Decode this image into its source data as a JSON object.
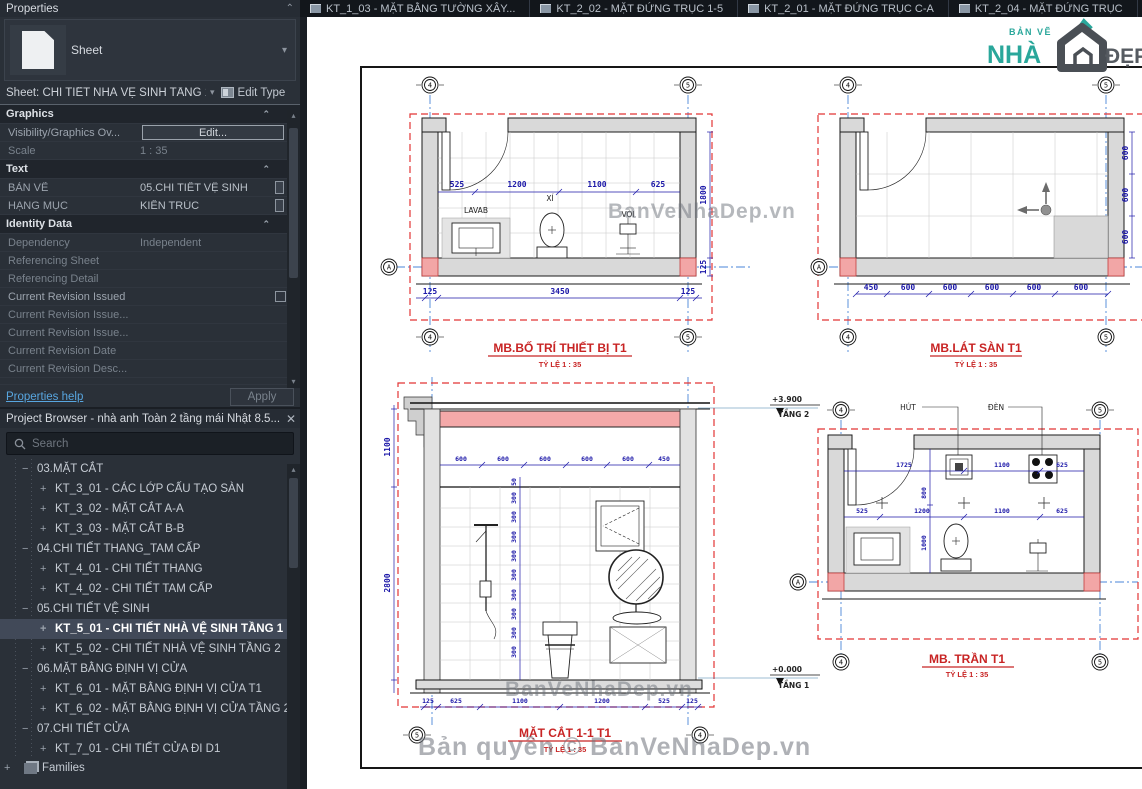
{
  "tabs": [
    {
      "label": "KT_1_03 - MẶT BẰNG TƯỜNG XÂY..."
    },
    {
      "label": "KT_2_02 - MẶT ĐỨNG TRỤC 1-5"
    },
    {
      "label": "KT_2_01 - MẶT ĐỨNG TRỤC C-A"
    },
    {
      "label": "KT_2_04 - MẶT ĐỨNG TRỤC"
    }
  ],
  "properties": {
    "title": "Properties",
    "type_label": "Sheet",
    "selector_label": "Sheet: CHI TIẾT NHÀ VỆ SINH TẦNG 1",
    "edit_type_label": "Edit Type",
    "rows": [
      {
        "kind": "section",
        "label": "Graphics"
      },
      {
        "kind": "row",
        "label": "Visibility/Graphics Ov...",
        "value": "Edit...",
        "control": "button"
      },
      {
        "kind": "row",
        "label": "Scale",
        "value": "1 : 35",
        "dim": "true"
      },
      {
        "kind": "section",
        "label": "Text"
      },
      {
        "kind": "row",
        "label": "BẢN VẼ",
        "value": "05.CHI TIẾT VỆ SINH",
        "tag": "true"
      },
      {
        "kind": "row",
        "label": "HẠNG MỤC",
        "value": "KIẾN TRÚC",
        "tag": "true"
      },
      {
        "kind": "section",
        "label": "Identity Data"
      },
      {
        "kind": "row",
        "label": "Dependency",
        "value": "Independent",
        "dim": "true"
      },
      {
        "kind": "row",
        "label": "Referencing Sheet",
        "value": "",
        "dim": "true"
      },
      {
        "kind": "row",
        "label": "Referencing Detail",
        "value": "",
        "dim": "true"
      },
      {
        "kind": "row",
        "label": "Current Revision Issued",
        "value": "",
        "control": "checkbox"
      },
      {
        "kind": "row",
        "label": "Current Revision Issue...",
        "value": "",
        "dim": "true"
      },
      {
        "kind": "row",
        "label": "Current Revision Issue...",
        "value": "",
        "dim": "true"
      },
      {
        "kind": "row",
        "label": "Current Revision Date",
        "value": "",
        "dim": "true"
      },
      {
        "kind": "row",
        "label": "Current Revision Desc...",
        "value": "",
        "dim": "true"
      }
    ],
    "help_label": "Properties help",
    "apply_label": "Apply"
  },
  "project_browser": {
    "title": "Project Browser - nhà anh Toàn 2 tầng mái Nhật 8.5...",
    "search_placeholder": "Search",
    "tree": [
      {
        "kind": "section",
        "expander": "−",
        "label": "03.MẶT CẮT"
      },
      {
        "kind": "leaf",
        "expander": "+",
        "label": "KT_3_01 - CÁC LỚP CẤU TẠO SÀN"
      },
      {
        "kind": "leaf",
        "expander": "+",
        "label": "KT_3_02 - MẶT CẮT A-A"
      },
      {
        "kind": "leaf",
        "expander": "+",
        "label": "KT_3_03 - MẶT CẮT B-B"
      },
      {
        "kind": "section",
        "expander": "−",
        "label": "04.CHI TIẾT THANG_TAM CẤP"
      },
      {
        "kind": "leaf",
        "expander": "+",
        "label": "KT_4_01 - CHI TIẾT THANG"
      },
      {
        "kind": "leaf",
        "expander": "+",
        "label": "KT_4_02 - CHI TIẾT TAM CẤP"
      },
      {
        "kind": "section",
        "expander": "−",
        "label": "05.CHI TIẾT VỆ SINH"
      },
      {
        "kind": "leaf",
        "expander": "+",
        "label": "KT_5_01 - CHI TIẾT NHÀ VỆ SINH TẦNG 1",
        "selected": "true"
      },
      {
        "kind": "leaf",
        "expander": "+",
        "label": "KT_5_02 - CHI TIẾT NHÀ VỆ SINH TẦNG 2"
      },
      {
        "kind": "section",
        "expander": "−",
        "label": "06.MẶT BẰNG ĐỊNH VỊ CỬA"
      },
      {
        "kind": "leaf",
        "expander": "+",
        "label": "KT_6_01 - MẶT BẰNG ĐỊNH VỊ CỬA T1"
      },
      {
        "kind": "leaf",
        "expander": "+",
        "label": "KT_6_02 - MẶT BẰNG ĐỊNH VỊ CỬA TẦNG 2"
      },
      {
        "kind": "section",
        "expander": "−",
        "label": "07.CHI TIẾT CỬA"
      },
      {
        "kind": "leaf",
        "expander": "+",
        "label": "KT_7_01 - CHI TIẾT CỬA ĐI D1"
      }
    ],
    "families_label": "Families"
  },
  "canvas": {
    "logo": {
      "small": "BẢN VẼ",
      "main": "NHÀ",
      "suffix": "ĐẸP"
    },
    "watermarks": {
      "plan": "BanVeNhaDep.vn",
      "section": "BanVeNhaDep.vn",
      "copyright": "Bản quyền © BanVeNhaDep.vn"
    },
    "drawings": [
      {
        "name": "MB.BỐ TRÍ THIẾT BỊ T1",
        "scale_label": "TỶ LỆ 1 : 35",
        "bubbles": {
          "top_left": "4",
          "top_right": "5",
          "row": "A",
          "bottom_left": "4",
          "bottom_right": "5"
        },
        "dims_inner": [
          "525",
          "1200",
          "1100",
          "625"
        ],
        "dims_right": [
          "1800",
          "125"
        ],
        "dims_bottom": [
          "125",
          "3450",
          "125"
        ],
        "fixture_labels": [
          "LAVAB",
          "XÍ",
          "VÒI"
        ]
      },
      {
        "name": "MB.LÁT SÀN T1",
        "scale_label": "TỶ LỆ 1 : 35",
        "bubbles": {
          "top_left": "4",
          "top_right": "5",
          "row": "A",
          "bottom_left": "4",
          "bottom_right": "5"
        },
        "dims_bottom": [
          "450",
          "600",
          "600",
          "600",
          "600",
          "600"
        ],
        "dims_right": [
          "600",
          "600",
          "600"
        ]
      },
      {
        "name": "MẶT CẮT 1-1 T1",
        "scale_label": "TỶ LỆ 1 : 35",
        "bubbles": {
          "bottom_left": "5",
          "bottom_right": "4"
        },
        "dims_left": [
          "1100",
          "2800"
        ],
        "dims_top": [
          "600",
          "600",
          "600",
          "600",
          "600",
          "450"
        ],
        "dims_tiles": [
          "50",
          "300",
          "300",
          "300",
          "300",
          "300",
          "300",
          "300",
          "300",
          "300"
        ],
        "dims_bottom": [
          "125",
          "625",
          "1100",
          "1200",
          "525",
          "125"
        ],
        "levels": [
          {
            "value": "+3.900",
            "name": "TẦNG 2"
          },
          {
            "value": "+0.000",
            "name": "TẦNG 1"
          }
        ]
      },
      {
        "name": "MB. TRẦN T1",
        "scale_label": "TỶ LỆ 1 : 35",
        "bubbles": {
          "top_left": "4",
          "top_right": "5",
          "row": "A",
          "bottom_left": "4",
          "bottom_right": "5"
        },
        "ceiling_labels": [
          "HÚT",
          "ĐÈN"
        ],
        "dims_upper": [
          "1725",
          "1100",
          "625"
        ],
        "dims_vertical": [
          "800",
          "1000"
        ],
        "dims_lower": [
          "525",
          "1200",
          "1100",
          "625"
        ]
      }
    ]
  }
}
